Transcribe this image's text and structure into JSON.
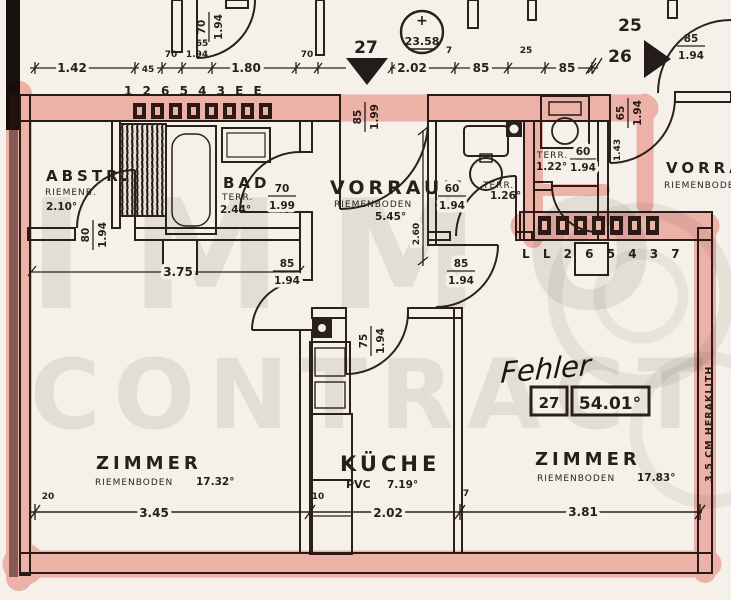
{
  "watermark": {
    "line1": "IMMO",
    "line2": "CONTRACT"
  },
  "handnote": {
    "text": "Fehler",
    "box_left": "27",
    "box_right": "54.01°"
  },
  "note_right": "3.5 CM HERAKLITH",
  "elevation": {
    "plus": "+",
    "value": "23.58"
  },
  "door_markers": {
    "d27": "27",
    "d26": "26",
    "n25_top": "25"
  },
  "rooms": {
    "abstr": {
      "name": "ABSTR.",
      "floor": "RIEMENB.",
      "area": "2.10°"
    },
    "bad": {
      "name": "BAD",
      "floor": "TERR.",
      "area": "2.44°"
    },
    "vorraum": {
      "name": "VORRAUM",
      "floor": "RIEMENBODEN",
      "area": "5.45°"
    },
    "wc": {
      "floor": "TERR.",
      "area": "1.26°"
    },
    "wash": {
      "floor": "TERR.",
      "area": "1.22°"
    },
    "kueche": {
      "name": "KÜCHE",
      "floor": "PVC",
      "area": "7.19°"
    },
    "zimmer_left": {
      "name": "ZIMMER",
      "floor": "RIEMENBODEN",
      "area": "17.32°"
    },
    "zimmer_right": {
      "name": "ZIMMER",
      "floor": "RIEMENBODEN",
      "area": "17.83°"
    },
    "vorraum_neighbor": {
      "name": "VORRAUM",
      "floor": "RIEMENBODEN"
    }
  },
  "doors": {
    "top_left": {
      "w": "70",
      "h": "1.94"
    },
    "entrance": {
      "w": "85",
      "h": "1.99"
    },
    "bad": {
      "w": "70",
      "h": "1.99"
    },
    "abstr": {
      "w": "80",
      "h": "1.94"
    },
    "wc": {
      "w": "60",
      "h": "1.94"
    },
    "wash": {
      "w": "60",
      "h": "1.94"
    },
    "neighbor": {
      "w": "65",
      "h": "1.94"
    },
    "zimmer_left": {
      "w": "85",
      "h": "1.94"
    },
    "zimmer_right": {
      "w": "85",
      "h": "1.94"
    },
    "kueche": {
      "w": "75",
      "h": "1.94"
    },
    "top_right": {
      "w": "85",
      "h": "1.94"
    }
  },
  "dims": {
    "top": {
      "a": "1.42",
      "b": "45",
      "c": "70",
      "d": "1.94",
      "e": "1.80",
      "f": "70",
      "g": "2.02",
      "h": "7",
      "i": "85",
      "j": "25",
      "k": "85"
    },
    "bottom": {
      "a": "20",
      "b": "3.45",
      "c": "10",
      "d": "2.02",
      "e": "7",
      "f": "3.81"
    },
    "interior": {
      "w375": "3.75",
      "h260": "2.60",
      "h143": "1.43",
      "s65": "65"
    }
  },
  "number_rows": {
    "top": "1 2 6 5 4 3 E E",
    "right": "L L 2 6 5 4 3 7"
  }
}
